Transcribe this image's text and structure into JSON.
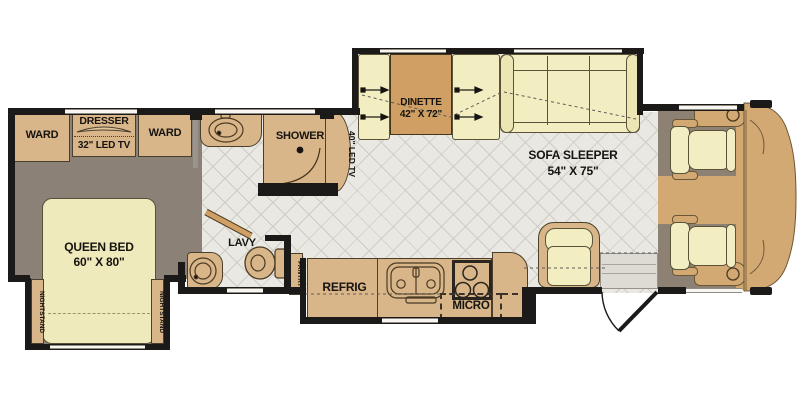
{
  "plan": {
    "type": "rv-floorplan",
    "bedroom": {
      "ward": "WARD",
      "dresser": "DRESSER",
      "tv": "32\" LED TV",
      "bed_name": "QUEEN BED",
      "bed_size": "60\" X 80\"",
      "nightstand": "NIGHTSTAND"
    },
    "bath": {
      "shower": "SHOWER",
      "tv": "40\" LED TV",
      "lavy": "LAVY"
    },
    "galley": {
      "pantry": "PANTRY",
      "refrig": "REFRIG",
      "micro": "MICRO"
    },
    "living": {
      "dinette_name": "DINETTE",
      "dinette_size": "42\" X 72\"",
      "sofa_name": "SOFA SLEEPER",
      "sofa_size": "54\" X 75\""
    },
    "colors": {
      "wall": "#1c1a18",
      "cabinet_tan": "#d9b689",
      "table_tan": "#cf9f63",
      "cushion_cream": "#f2eec2",
      "bedroom_floor": "#8b8177",
      "cab_floor": "#8d8174",
      "tile_floor": "#eae8e3"
    }
  }
}
